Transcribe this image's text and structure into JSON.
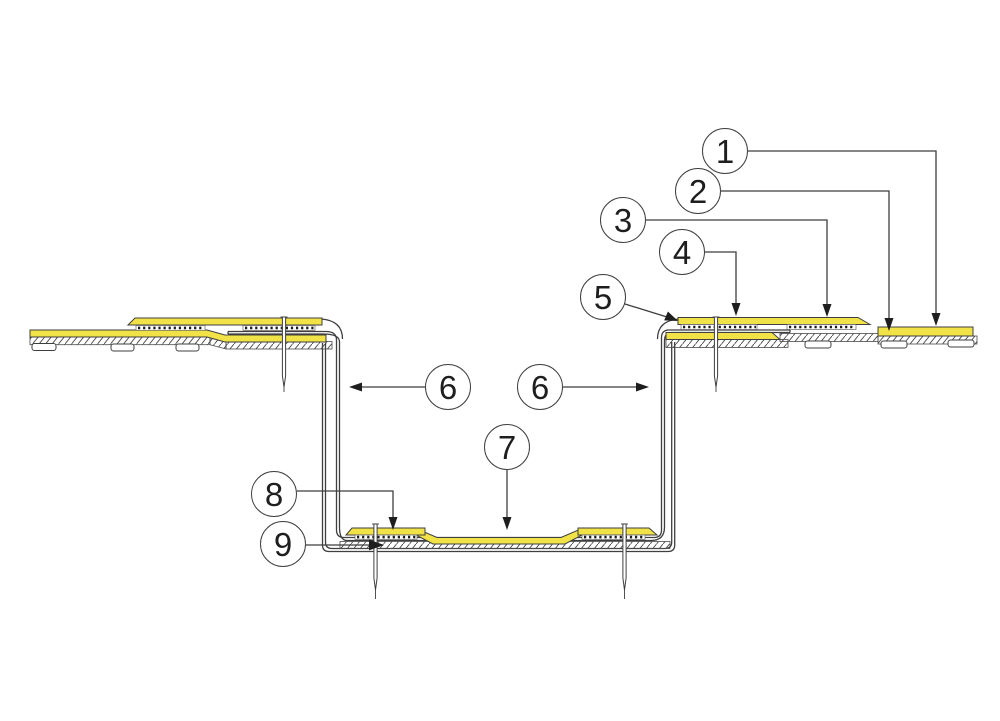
{
  "diagram": {
    "kind": "construction-detail-cross-section",
    "callouts": [
      {
        "label": "1"
      },
      {
        "label": "2"
      },
      {
        "label": "3"
      },
      {
        "label": "4"
      },
      {
        "label": "5"
      },
      {
        "label": "6"
      },
      {
        "label": "6"
      },
      {
        "label": "7"
      },
      {
        "label": "8"
      },
      {
        "label": "9"
      }
    ],
    "colors": {
      "membrane_yellow": "#F1E247",
      "line": "#3F3F3F",
      "adhesive_dots": "#1A1A1A",
      "hatch": "#4A4A4A",
      "background": "#FFFFFF"
    }
  }
}
